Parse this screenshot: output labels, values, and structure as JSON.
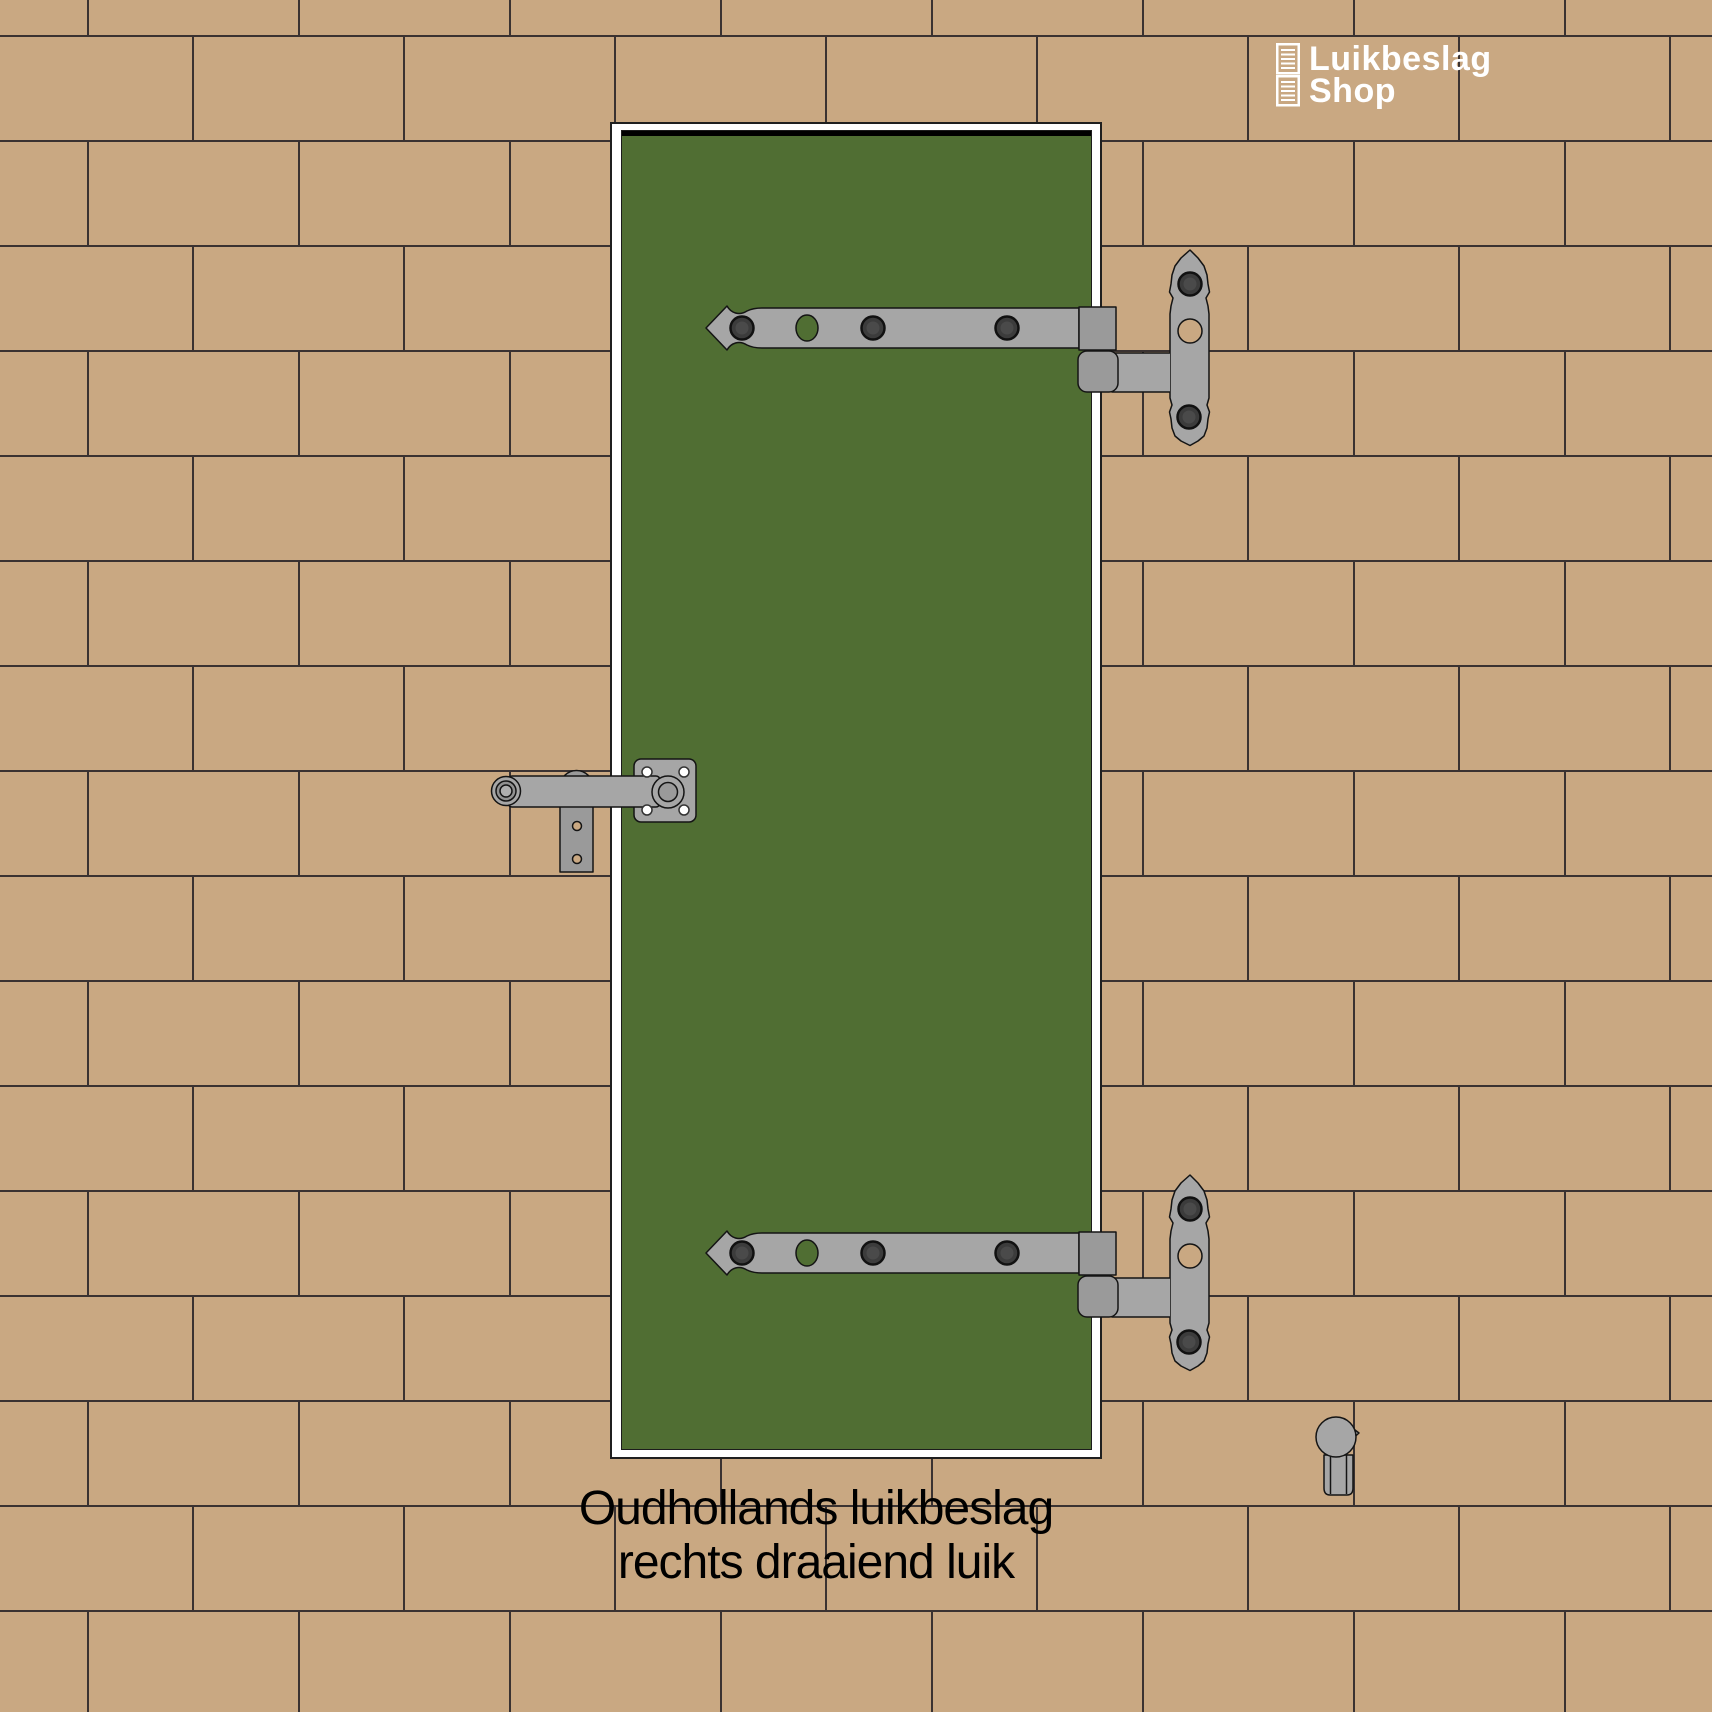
{
  "logo": {
    "title": "Luikbeslag",
    "subtitle": "Shop",
    "icon": "shutter-louvers-icon"
  },
  "caption": {
    "line1": "Oudhollands luikbeslag",
    "line2": "rechts draaiend luik"
  },
  "objects": [
    "brick-wall",
    "window-frame",
    "green-shutter",
    "top-hinge-strap-with-wall-pintle-plate",
    "bottom-hinge-strap-with-wall-pintle-plate",
    "shutter-catch-with-wall-eye",
    "loose-pintle"
  ],
  "colors": {
    "brick": "#c9a882",
    "mortar": "#3a3231",
    "frame": "#ffffff",
    "frame_outline": "#1f1f1f",
    "shutter": "#506e33",
    "shutter_shadow": "#000000",
    "metal": "#a6a6a6",
    "metal_mid": "#9a9a9a",
    "metal_deep": "#919191",
    "bolt": "#3c3c3c",
    "bolt_edge": "#111111",
    "outline": "#141414",
    "screw": "#ffffff",
    "caption_text": "#000000",
    "logo_text": "#ffffff"
  }
}
